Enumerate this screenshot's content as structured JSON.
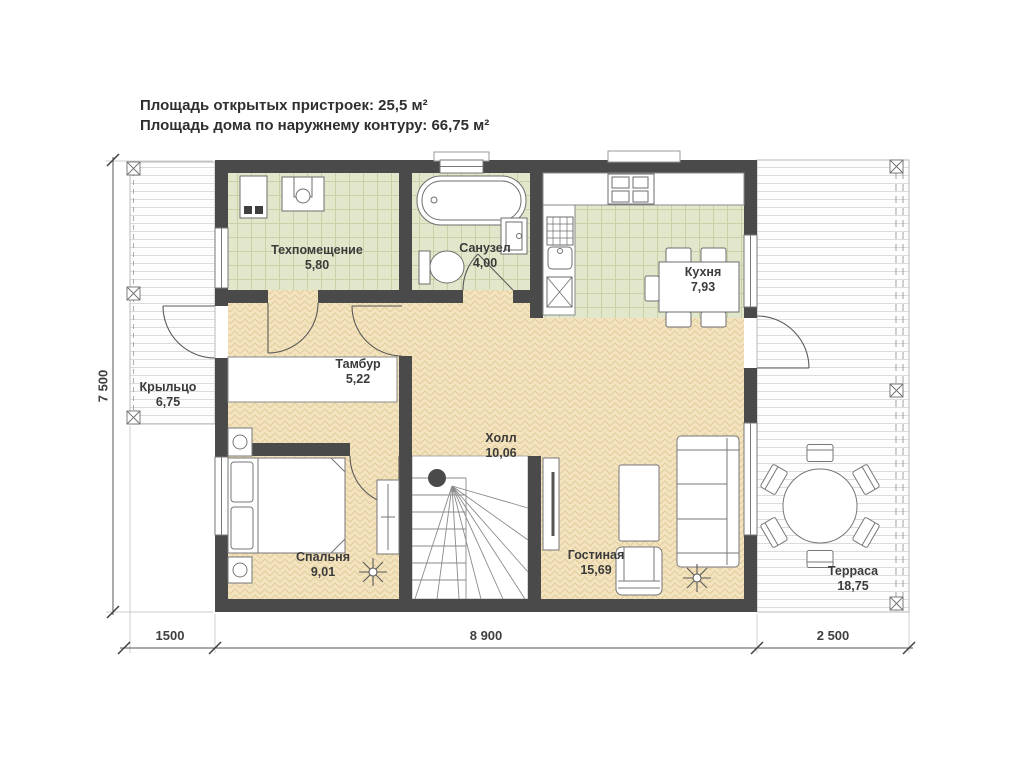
{
  "title": {
    "line1": "Площадь открытых пристроек: 25,5 м²",
    "line2": "Площадь дома по наружнему контуру: 66,75 м²"
  },
  "rooms": {
    "tech": {
      "name": "Техпомещение",
      "area": "5,80"
    },
    "bath": {
      "name": "Санузел",
      "area": "4,00"
    },
    "kitchen": {
      "name": "Кухня",
      "area": "7,93"
    },
    "tambour": {
      "name": "Тамбур",
      "area": "5,22"
    },
    "porch": {
      "name": "Крыльцо",
      "area": "6,75"
    },
    "hall": {
      "name": "Холл",
      "area": "10,06"
    },
    "bedroom": {
      "name": "Спальня",
      "area": "9,01"
    },
    "living": {
      "name": "Гостиная",
      "area": "15,69"
    },
    "terrace": {
      "name": "Терраса",
      "area": "18,75"
    }
  },
  "dims": {
    "house_height": "7 500",
    "porch_width": "1500",
    "house_width": "8 900",
    "terrace_width": "2 500"
  },
  "colors": {
    "wall": "#4a4a4a",
    "tile_floor": "#e2e6ca",
    "parquet_floor": "#f3e3bf",
    "deck": "#fdfdfd"
  }
}
